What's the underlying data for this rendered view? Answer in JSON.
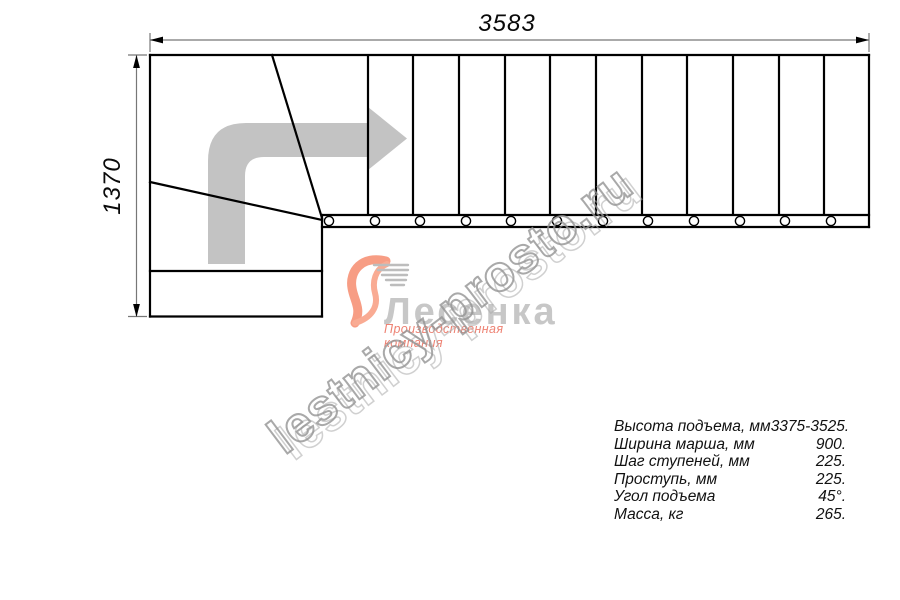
{
  "dimensions": {
    "width_label": "3583",
    "height_label": "1370"
  },
  "watermark": {
    "text": "lestnicy-prosto.ru"
  },
  "logo": {
    "name": "Лесенка",
    "tagline": "Производственная компания",
    "swoosh_color": "#f79d84",
    "name_color": "#c7c7c7",
    "tagline_color": "#ee8273"
  },
  "specs": {
    "rows": [
      {
        "label": "Высота подъема, мм",
        "value": "3375-3525."
      },
      {
        "label": "Ширина марша, мм",
        "value": "900."
      },
      {
        "label": "Шаг ступеней, мм",
        "value": "225."
      },
      {
        "label": "Проступь, мм",
        "value": "225."
      },
      {
        "label": "Угол подъема",
        "value": "45°."
      },
      {
        "label": "Масса, кг",
        "value": "265."
      }
    ]
  },
  "drawing": {
    "type": "staircase plan (top view) with 90° turn",
    "tread_count": 12,
    "line_color": "#000000",
    "direction_arrow_color": "#c3c3c3",
    "dimension_line_color": "#777777"
  }
}
